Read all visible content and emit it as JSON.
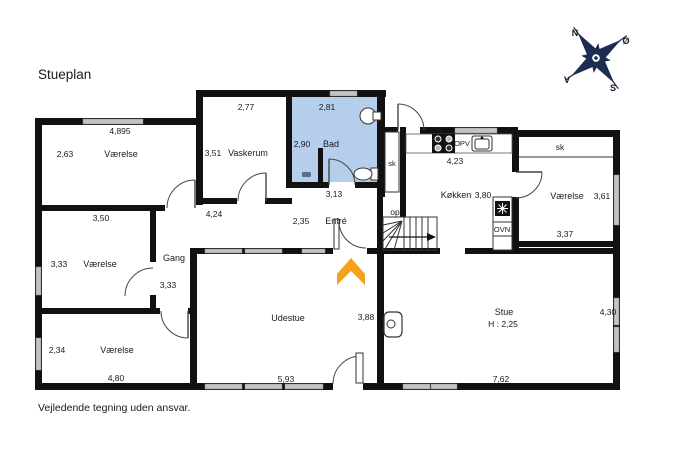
{
  "header": {
    "title": "Stueplan"
  },
  "footer": {
    "disclaimer": "Vejledende tegning uden ansvar."
  },
  "compass": {
    "north": "N",
    "east": "Ø",
    "south": "S",
    "west": "V"
  },
  "colors": {
    "wall": "#111111",
    "bath_fill": "#b5ceec",
    "window_gray": "#c3c3c3",
    "entrance_arrow": "#F5A11C",
    "compass_navy": "#1c2d52"
  },
  "rooms": {
    "vaerelse_nw": {
      "name": "Værelse",
      "width": "4,895",
      "height": "2,63"
    },
    "vaskerum": {
      "name": "Vaskerum",
      "width_top": "2,77",
      "height": "3,51",
      "width_bottom": "4,24"
    },
    "bad": {
      "name": "Bad",
      "width_top": "2,81",
      "height": "2,90",
      "width_bottom": "3,13"
    },
    "entre": {
      "name": "Entré",
      "width": "2,35"
    },
    "gang": {
      "name": "Gang",
      "height": "3,33"
    },
    "vaerelse_w": {
      "name": "Værelse",
      "width": "3,50",
      "height": "3,33"
    },
    "vaerelse_sw": {
      "name": "Værelse",
      "width": "4,80",
      "height": "2,34"
    },
    "koekken": {
      "name": "Køkken",
      "width": "4,23",
      "height": "3,80"
    },
    "vaerelse_e": {
      "name": "Værelse",
      "width": "3,37",
      "height": "3,61"
    },
    "udestue": {
      "name": "Udestue",
      "width": "5,93",
      "height": "3,88"
    },
    "stue": {
      "name": "Stue",
      "ceiling_height": "H : 2,25",
      "width": "7,62",
      "height": "4,30"
    }
  },
  "labels": {
    "stairs_up": "op",
    "closet_hall": "sk",
    "closet_east": "sk",
    "dishwasher": "OPV",
    "oven": "OVN"
  }
}
